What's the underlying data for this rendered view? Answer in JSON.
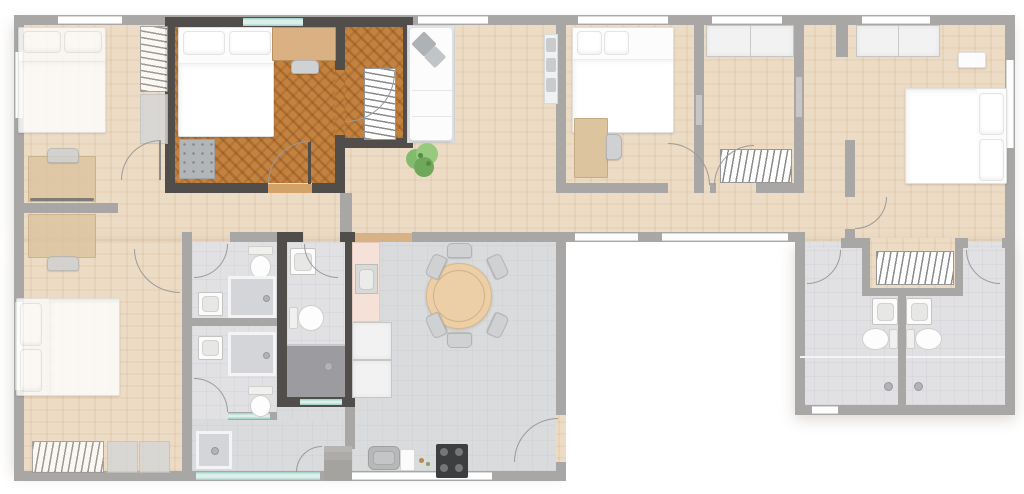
{
  "scene": {
    "kind": "apartment floor plan",
    "view": "top-down",
    "highlight": "selected suite with dark walls and dark wood floor: bedroom, hall alcove with radiator, private bathroom"
  },
  "palette": {
    "wall": "#a8a7a5",
    "wallDark": "#504d4b",
    "floorBeige": "#eddcc5",
    "floorWoodDark": "#c3823f",
    "floorBath": "#e1e1e4",
    "floorKitchen": "#dadbdd",
    "floorShower": "#9c9ca0",
    "furnWhite": "#fcfcfc",
    "furnGray": "#d5d6d7",
    "deskWood": "#dcc49f",
    "tableWood": "#eccfa7",
    "counterPink": "#f6e1d9",
    "glass": "#ddefeb",
    "glassEdge": "#a9d6cc",
    "plant": "#83bb6e",
    "stove": "#3c3e40",
    "arc": "#9a9a98"
  },
  "highlighted_unit": {
    "selected": true,
    "rooms": [
      "bedroom",
      "alcove-hall",
      "bathroom"
    ],
    "furniture": [
      "double-bed",
      "desk",
      "desk-chair",
      "kitchenette-counter",
      "radiator",
      "wash-basin",
      "toilet",
      "shower",
      "window"
    ]
  },
  "rooms": [
    {
      "name": "bedroom-top-left",
      "furniture": [
        "double-bed",
        "desk",
        "chair",
        "radiator",
        "cabinet"
      ]
    },
    {
      "name": "bedroom-bottom-left",
      "furniture": [
        "double-bed",
        "desk",
        "chair",
        "radiator",
        "cabinet",
        "cabinet"
      ]
    },
    {
      "name": "bathroom-1",
      "furniture": [
        "toilet",
        "wash-basin",
        "shower"
      ]
    },
    {
      "name": "bathroom-2",
      "furniture": [
        "wash-basin",
        "shower",
        "toilet"
      ]
    },
    {
      "name": "entry-hall",
      "furniture": [
        "shower-mat",
        "glazed-entrance"
      ]
    },
    {
      "name": "kitchen-dining",
      "furniture": [
        "counter",
        "sink",
        "refrigerator",
        "refrigerator",
        "dining-table",
        "dining-chair",
        "dining-chair",
        "dining-chair",
        "dining-chair",
        "dining-chair",
        "dining-chair",
        "cooktop",
        "basin"
      ]
    },
    {
      "name": "living-hall",
      "furniture": [
        "sofa",
        "plant",
        "kitchenette"
      ]
    },
    {
      "name": "bedroom-middle",
      "furniture": [
        "double-bed",
        "desk",
        "chair"
      ]
    },
    {
      "name": "storage-room",
      "furniture": [
        "wardrobe",
        "radiator"
      ]
    },
    {
      "name": "bedroom-right",
      "furniture": [
        "wardrobe",
        "bench",
        "double-bed",
        "radiator"
      ]
    },
    {
      "name": "bathroom-right-1",
      "furniture": [
        "wash-basin",
        "toilet",
        "shower"
      ]
    },
    {
      "name": "bathroom-right-2",
      "furniture": [
        "wash-basin",
        "toilet",
        "shower"
      ]
    }
  ]
}
